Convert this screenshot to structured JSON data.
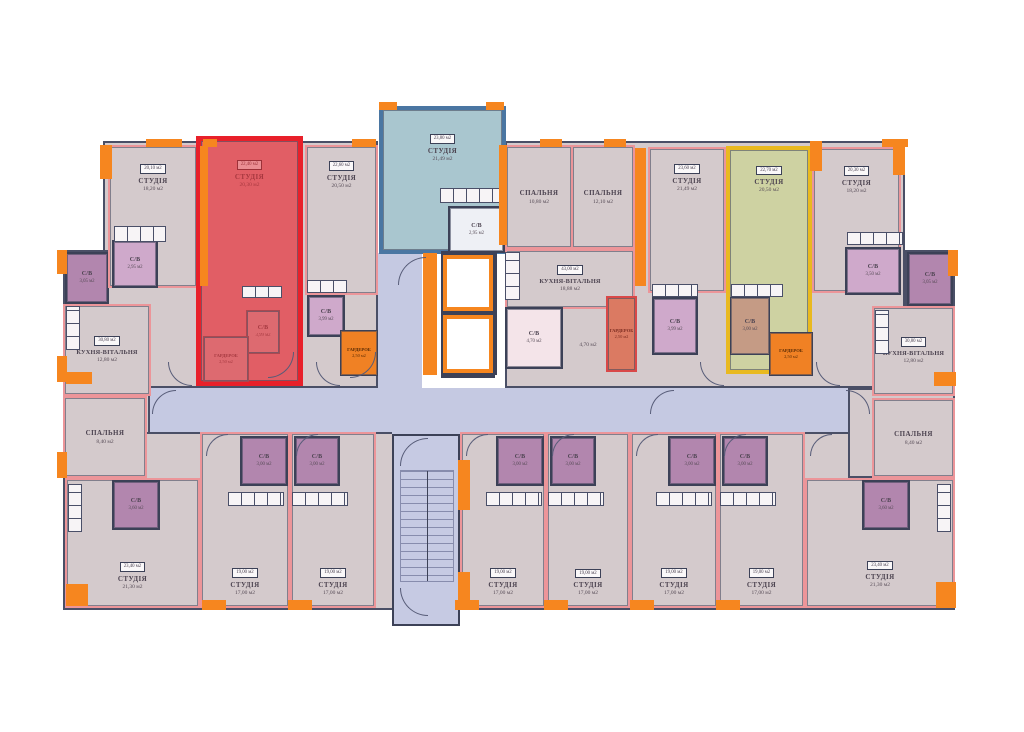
{
  "palette": {
    "wall": "#3c4157",
    "unit_wall": "#ec9599",
    "room_fill": "#d4cacc",
    "corridor_fill": "#c5c9e2",
    "orange": "#f6861f",
    "red_highlight_fill": "#e15e65",
    "red_highlight_border": "#e8202a",
    "blue_highlight_fill": "#a9c6cf",
    "blue_highlight_border": "#4a76a2",
    "yellow_highlight_fill": "#ced2a2",
    "yellow_highlight_border": "#e9b91f",
    "bath_fill": "#b286ae",
    "bath_fill_light": "#cfa9cb",
    "stairs_fill": "#c6cae3"
  },
  "base": [
    {
      "x": 103,
      "y": 141,
      "w": 275,
      "h": 247
    },
    {
      "x": 63,
      "y": 250,
      "w": 45,
      "h": 228
    },
    {
      "x": 103,
      "y": 388,
      "w": 47,
      "h": 90
    },
    {
      "x": 63,
      "y": 432,
      "w": 892,
      "h": 178
    },
    {
      "x": 505,
      "y": 141,
      "w": 400,
      "h": 247
    },
    {
      "x": 905,
      "y": 250,
      "w": 50,
      "h": 228
    },
    {
      "x": 848,
      "y": 388,
      "w": 107,
      "h": 90
    }
  ],
  "corridors": [
    {
      "x": 150,
      "y": 388,
      "w": 698,
      "h": 44
    },
    {
      "x": 378,
      "y": 253,
      "w": 44,
      "h": 137
    },
    {
      "x": 392,
      "y": 428,
      "w": 68,
      "h": 10
    }
  ],
  "rooms": [
    {
      "id": "bath-left-top",
      "t": "С/В",
      "a": "3,05 м2",
      "x": 65,
      "y": 252,
      "w": 44,
      "h": 52,
      "fill": "#b286ae",
      "border": "#3c4157",
      "bw": 2,
      "cls": "small"
    },
    {
      "id": "kitchen-living-left",
      "t": "КУХНЯ-ВІТАЛЬНЯ",
      "a": "12,80 м2",
      "b": "30,80 м2",
      "x": 63,
      "y": 304,
      "w": 88,
      "h": 92,
      "cls": "kitchenname"
    },
    {
      "id": "bedroom-left",
      "t": "СПАЛЬНЯ",
      "a": "8,40 м2",
      "x": 63,
      "y": 396,
      "w": 84,
      "h": 82
    },
    {
      "id": "studio-top-1",
      "t": "СТУДІЯ",
      "a": "18,20 м2",
      "b": "20,10 м2",
      "x": 108,
      "y": 145,
      "w": 90,
      "h": 143,
      "labelPos": "upper"
    },
    {
      "id": "bath-studio-1",
      "t": "С/В",
      "a": "2,95 м2",
      "x": 112,
      "y": 240,
      "w": 46,
      "h": 48,
      "fill": "#cfa9cb",
      "border": "#3c4157",
      "bw": 2,
      "cls": "small"
    },
    {
      "id": "apartment-red-studio",
      "t": "СТУДІЯ",
      "a": "20,30 м2",
      "b": "22,40 м2",
      "x": 196,
      "y": 136,
      "w": 107,
      "h": 250,
      "fill": "#e15e65",
      "border": "#e8202a",
      "bw": 5,
      "cls": "t-red",
      "labelPos": "upper"
    },
    {
      "id": "bath-red",
      "t": "С/В",
      "a": "3,99 м2",
      "x": 246,
      "y": 310,
      "w": 34,
      "h": 44,
      "fill": "#dd6a70",
      "border": "#aa4850",
      "bw": 1.5,
      "cls": "small t-red"
    },
    {
      "id": "wardrobe-red",
      "t": "ГАРДЕРОБ",
      "a": "2,50 м2",
      "x": 203,
      "y": 336,
      "w": 46,
      "h": 46,
      "fill": "#dd6a70",
      "border": "#aa4850",
      "bw": 1.5,
      "cls": "tiny t-red"
    },
    {
      "id": "studio-top-2",
      "t": "СТУДІЯ",
      "a": "20,50 м2",
      "b": "22,60 м2",
      "x": 305,
      "y": 145,
      "w": 73,
      "h": 150,
      "labelPos": "upper"
    },
    {
      "id": "bath-studio-2",
      "t": "С/В",
      "a": "3,99 м2",
      "x": 307,
      "y": 295,
      "w": 38,
      "h": 42,
      "fill": "#cfa9cb",
      "border": "#3c4157",
      "bw": 2,
      "cls": "small"
    },
    {
      "id": "wardrobe-studio-2",
      "t": "ГАРДЕРОБ",
      "a": "2,50 м2",
      "x": 340,
      "y": 330,
      "w": 38,
      "h": 46,
      "fill": "#f08124",
      "border": "#3c4157",
      "bw": 1.5,
      "cls": "tiny t-orange"
    },
    {
      "id": "apartment-blue-studio",
      "t": "СТУДІЯ",
      "a": "21,49 м2",
      "b": "23,80 м2",
      "x": 379,
      "y": 106,
      "w": 127,
      "h": 148,
      "fill": "#a9c6cf",
      "border": "#4a76a2",
      "bw": 4,
      "labelPos": "upper"
    },
    {
      "id": "bath-blue",
      "t": "С/В",
      "a": "2,95 м2",
      "x": 448,
      "y": 206,
      "w": 57,
      "h": 47,
      "fill": "#eef0f5",
      "border": "#3c4157",
      "bw": 2,
      "cls": "small"
    },
    {
      "id": "bedroom-center-1",
      "t": "СПАЛЬНЯ",
      "a": "10,80 м2",
      "x": 505,
      "y": 145,
      "w": 68,
      "h": 104,
      "dashedRight": true
    },
    {
      "id": "bedroom-center-2",
      "t": "СПАЛЬНЯ",
      "a": "12,10 м2",
      "x": 571,
      "y": 145,
      "w": 64,
      "h": 104
    },
    {
      "id": "kitchen-living-center",
      "t": "КУХНЯ-ВІТАЛЬНЯ",
      "a": "18,88 м2",
      "b": "43,00 м2",
      "x": 505,
      "y": 249,
      "w": 130,
      "h": 60,
      "cls": "kitchenname"
    },
    {
      "id": "bath-center",
      "t": "С/В",
      "a": "4,70 м2",
      "x": 505,
      "y": 307,
      "w": 58,
      "h": 62,
      "fill": "#f4e4e9",
      "border": "#3c4157",
      "bw": 2,
      "cls": "small"
    },
    {
      "id": "wardrobe-center",
      "t": "ГАРДЕРОБ",
      "a": "2,50 м2",
      "x": 606,
      "y": 296,
      "w": 31,
      "h": 76,
      "fill": "#db7a62",
      "border": "#d94848",
      "bw": 2,
      "cls": "tiny t-redward"
    },
    {
      "id": "studio-top-3",
      "t": "СТУДІЯ",
      "a": "21,49 м2",
      "b": "23,60 м2",
      "x": 648,
      "y": 147,
      "w": 78,
      "h": 146,
      "labelPos": "upper"
    },
    {
      "id": "bath-studio-3",
      "t": "С/В",
      "a": "3,99 м2",
      "x": 652,
      "y": 297,
      "w": 46,
      "h": 58,
      "fill": "#cfa9cb",
      "border": "#3c4157",
      "bw": 2,
      "cls": "small"
    },
    {
      "id": "apartment-yellow-studio",
      "t": "СТУДІЯ",
      "a": "20,50 м2",
      "b": "22,70 м2",
      "x": 726,
      "y": 146,
      "w": 86,
      "h": 228,
      "fill": "#ced2a2",
      "border": "#e9b91f",
      "bw": 4,
      "labelPos": "upper"
    },
    {
      "id": "bath-yellow",
      "t": "С/В",
      "a": "3,00 м2",
      "x": 730,
      "y": 297,
      "w": 40,
      "h": 58,
      "fill": "#c59b85",
      "border": "#3c4157",
      "bw": 1.5,
      "cls": "small"
    },
    {
      "id": "wardrobe-yellow",
      "t": "ГАРДЕРОБ",
      "a": "2,50 м2",
      "x": 769,
      "y": 332,
      "w": 44,
      "h": 44,
      "fill": "#f08124",
      "border": "#3c4157",
      "bw": 1.5,
      "cls": "tiny t-orange"
    },
    {
      "id": "studio-top-4",
      "t": "СТУДІЯ",
      "a": "18,20 м2",
      "b": "20,30 м2",
      "x": 812,
      "y": 147,
      "w": 89,
      "h": 146,
      "labelPos": "upper"
    },
    {
      "id": "bath-studio-4",
      "t": "С/В",
      "a": "3,50 м2",
      "x": 845,
      "y": 247,
      "w": 56,
      "h": 48,
      "fill": "#cfa9cb",
      "border": "#3c4157",
      "bw": 2,
      "cls": "small"
    },
    {
      "id": "bath-right-top",
      "t": "С/В",
      "a": "3,05 м2",
      "x": 907,
      "y": 252,
      "w": 46,
      "h": 54,
      "fill": "#b286ae",
      "border": "#3c4157",
      "bw": 2,
      "cls": "small"
    },
    {
      "id": "kitchen-living-right",
      "t": "КУХНЯ-ВІТАЛЬНЯ",
      "a": "12,80 м2",
      "b": "30,80 м2",
      "x": 872,
      "y": 306,
      "w": 83,
      "h": 90,
      "cls": "kitchenname"
    },
    {
      "id": "bedroom-right",
      "t": "СПАЛЬНЯ",
      "a": "8,40 м2",
      "x": 872,
      "y": 398,
      "w": 83,
      "h": 80
    },
    {
      "id": "studio-corner-bl",
      "t": "СТУДІЯ",
      "a": "21,30 м2",
      "b": "23,40 м2",
      "x": 65,
      "y": 478,
      "w": 135,
      "h": 130,
      "labelPos": "lower"
    },
    {
      "id": "bath-corner-bl",
      "t": "С/В",
      "a": "3,60 м2",
      "x": 112,
      "y": 480,
      "w": 48,
      "h": 50,
      "fill": "#b286ae",
      "border": "#3c4157",
      "bw": 2,
      "cls": "small"
    },
    {
      "id": "studio-bottom-1",
      "t": "СТУДІЯ",
      "a": "17,00 м2",
      "b": "19,00 м2",
      "x": 200,
      "y": 432,
      "w": 90,
      "h": 176,
      "labelPos": "lower"
    },
    {
      "id": "bath-bottom-1",
      "t": "С/В",
      "a": "3,00 м2",
      "x": 240,
      "y": 436,
      "w": 48,
      "h": 50,
      "fill": "#b286ae",
      "border": "#3c4157",
      "bw": 2,
      "cls": "small"
    },
    {
      "id": "studio-bottom-2",
      "t": "СТУДІЯ",
      "a": "17,00 м2",
      "b": "19,00 м2",
      "x": 290,
      "y": 432,
      "w": 86,
      "h": 176,
      "labelPos": "lower"
    },
    {
      "id": "bath-bottom-2",
      "t": "С/В",
      "a": "3,00 м2",
      "x": 294,
      "y": 436,
      "w": 46,
      "h": 50,
      "fill": "#b286ae",
      "border": "#3c4157",
      "bw": 2,
      "cls": "small"
    },
    {
      "id": "studio-bottom-3",
      "t": "СТУДІЯ",
      "a": "17,00 м2",
      "b": "19,00 м2",
      "x": 460,
      "y": 432,
      "w": 86,
      "h": 176,
      "labelPos": "lower"
    },
    {
      "id": "bath-bottom-3",
      "t": "С/В",
      "a": "3,00 м2",
      "x": 496,
      "y": 436,
      "w": 48,
      "h": 50,
      "fill": "#b286ae",
      "border": "#3c4157",
      "bw": 2,
      "cls": "small"
    },
    {
      "id": "studio-bottom-4",
      "t": "СТУДІЯ",
      "a": "17,00 м2",
      "b": "19,00 м2",
      "x": 546,
      "y": 432,
      "w": 84,
      "h": 176,
      "labelPos": "lower"
    },
    {
      "id": "bath-bottom-4",
      "t": "С/В",
      "a": "3,00 м2",
      "x": 550,
      "y": 436,
      "w": 46,
      "h": 50,
      "fill": "#b286ae",
      "border": "#3c4157",
      "bw": 2,
      "cls": "small"
    },
    {
      "id": "studio-bottom-5",
      "t": "СТУДІЯ",
      "a": "17,00 м2",
      "b": "19,00 м2",
      "x": 630,
      "y": 432,
      "w": 88,
      "h": 176,
      "labelPos": "lower"
    },
    {
      "id": "bath-bottom-5",
      "t": "С/В",
      "a": "3,00 м2",
      "x": 668,
      "y": 436,
      "w": 48,
      "h": 50,
      "fill": "#b286ae",
      "border": "#3c4157",
      "bw": 2,
      "cls": "small"
    },
    {
      "id": "studio-bottom-6",
      "t": "СТУДІЯ",
      "a": "17,00 м2",
      "b": "19,00 м2",
      "x": 718,
      "y": 432,
      "w": 87,
      "h": 176,
      "labelPos": "lower"
    },
    {
      "id": "bath-bottom-6",
      "t": "С/В",
      "a": "3,00 м2",
      "x": 722,
      "y": 436,
      "w": 46,
      "h": 50,
      "fill": "#b286ae",
      "border": "#3c4157",
      "bw": 2,
      "cls": "small"
    },
    {
      "id": "studio-corner-br",
      "t": "СТУДІЯ",
      "a": "21,30 м2",
      "b": "23,40 м2",
      "x": 805,
      "y": 478,
      "w": 150,
      "h": 130,
      "labelPos": "lower"
    },
    {
      "id": "bath-corner-br",
      "t": "С/В",
      "a": "3,60 м2",
      "x": 862,
      "y": 480,
      "w": 48,
      "h": 50,
      "fill": "#b286ae",
      "border": "#3c4157",
      "bw": 2,
      "cls": "small"
    }
  ],
  "elevators": [
    {
      "x": 443,
      "y": 255,
      "w": 50,
      "h": 56
    },
    {
      "x": 443,
      "y": 315,
      "w": 50,
      "h": 58
    }
  ],
  "stairs": {
    "box": {
      "x": 392,
      "y": 434,
      "w": 68,
      "h": 192
    },
    "flight": {
      "x": 400,
      "y": 470,
      "w": 54,
      "h": 112
    }
  },
  "kitchens": [
    {
      "x": 114,
      "y": 226,
      "w": 52,
      "h": 16,
      "dir": "h"
    },
    {
      "x": 307,
      "y": 280,
      "w": 40,
      "h": 13,
      "dir": "h"
    },
    {
      "x": 440,
      "y": 188,
      "w": 60,
      "h": 15,
      "dir": "h"
    },
    {
      "x": 652,
      "y": 284,
      "w": 46,
      "h": 13,
      "dir": "h"
    },
    {
      "x": 731,
      "y": 284,
      "w": 52,
      "h": 13,
      "dir": "h"
    },
    {
      "x": 847,
      "y": 232,
      "w": 56,
      "h": 13,
      "dir": "h"
    },
    {
      "x": 505,
      "y": 252,
      "w": 15,
      "h": 48,
      "dir": "v"
    },
    {
      "x": 66,
      "y": 306,
      "w": 14,
      "h": 44,
      "dir": "v"
    },
    {
      "x": 875,
      "y": 310,
      "w": 14,
      "h": 44,
      "dir": "v"
    },
    {
      "x": 228,
      "y": 492,
      "w": 56,
      "h": 14,
      "dir": "h"
    },
    {
      "x": 292,
      "y": 492,
      "w": 56,
      "h": 14,
      "dir": "h"
    },
    {
      "x": 486,
      "y": 492,
      "w": 56,
      "h": 14,
      "dir": "h"
    },
    {
      "x": 548,
      "y": 492,
      "w": 56,
      "h": 14,
      "dir": "h"
    },
    {
      "x": 656,
      "y": 492,
      "w": 56,
      "h": 14,
      "dir": "h"
    },
    {
      "x": 720,
      "y": 492,
      "w": 56,
      "h": 14,
      "dir": "h"
    },
    {
      "x": 68,
      "y": 484,
      "w": 14,
      "h": 48,
      "dir": "v"
    },
    {
      "x": 937,
      "y": 484,
      "w": 14,
      "h": 48,
      "dir": "v"
    },
    {
      "x": 242,
      "y": 286,
      "w": 40,
      "h": 12,
      "dir": "h"
    }
  ],
  "accents": [
    {
      "x": 100,
      "y": 145,
      "w": 12,
      "h": 34,
      "c": "orange"
    },
    {
      "x": 146,
      "y": 139,
      "w": 36,
      "h": 8,
      "c": "orange"
    },
    {
      "x": 203,
      "y": 139,
      "w": 14,
      "h": 8,
      "c": "orange"
    },
    {
      "x": 352,
      "y": 139,
      "w": 24,
      "h": 8,
      "c": "orange"
    },
    {
      "x": 379,
      "y": 102,
      "w": 18,
      "h": 8,
      "c": "orange"
    },
    {
      "x": 486,
      "y": 102,
      "w": 18,
      "h": 8,
      "c": "orange"
    },
    {
      "x": 499,
      "y": 145,
      "w": 8,
      "h": 100,
      "c": "orange"
    },
    {
      "x": 200,
      "y": 146,
      "w": 8,
      "h": 140,
      "c": "orange"
    },
    {
      "x": 635,
      "y": 148,
      "w": 11,
      "h": 138,
      "c": "orange"
    },
    {
      "x": 540,
      "y": 139,
      "w": 22,
      "h": 8,
      "c": "orange"
    },
    {
      "x": 604,
      "y": 139,
      "w": 22,
      "h": 8,
      "c": "orange"
    },
    {
      "x": 882,
      "y": 139,
      "w": 26,
      "h": 8,
      "c": "orange"
    },
    {
      "x": 893,
      "y": 145,
      "w": 12,
      "h": 30,
      "c": "orange"
    },
    {
      "x": 810,
      "y": 141,
      "w": 12,
      "h": 30,
      "c": "orange"
    },
    {
      "x": 57,
      "y": 250,
      "w": 10,
      "h": 24,
      "c": "orange"
    },
    {
      "x": 57,
      "y": 356,
      "w": 10,
      "h": 26,
      "c": "orange"
    },
    {
      "x": 66,
      "y": 372,
      "w": 26,
      "h": 12,
      "c": "orange"
    },
    {
      "x": 57,
      "y": 452,
      "w": 10,
      "h": 26,
      "c": "orange"
    },
    {
      "x": 66,
      "y": 584,
      "w": 22,
      "h": 22,
      "c": "orange"
    },
    {
      "x": 202,
      "y": 600,
      "w": 24,
      "h": 10,
      "c": "orange"
    },
    {
      "x": 288,
      "y": 600,
      "w": 24,
      "h": 10,
      "c": "orange"
    },
    {
      "x": 455,
      "y": 600,
      "w": 24,
      "h": 10,
      "c": "orange"
    },
    {
      "x": 544,
      "y": 600,
      "w": 24,
      "h": 10,
      "c": "orange"
    },
    {
      "x": 630,
      "y": 600,
      "w": 24,
      "h": 10,
      "c": "orange"
    },
    {
      "x": 716,
      "y": 600,
      "w": 24,
      "h": 10,
      "c": "orange"
    },
    {
      "x": 936,
      "y": 582,
      "w": 20,
      "h": 26,
      "c": "orange"
    },
    {
      "x": 934,
      "y": 372,
      "w": 22,
      "h": 14,
      "c": "orange"
    },
    {
      "x": 948,
      "y": 250,
      "w": 10,
      "h": 26,
      "c": "orange"
    },
    {
      "x": 423,
      "y": 253,
      "w": 14,
      "h": 122,
      "c": "orange"
    },
    {
      "x": 458,
      "y": 460,
      "w": 12,
      "h": 50,
      "c": "orange"
    },
    {
      "x": 458,
      "y": 572,
      "w": 12,
      "h": 36,
      "c": "orange"
    },
    {
      "x": 441,
      "y": 251,
      "w": 54,
      "h": 4,
      "c": "navy"
    },
    {
      "x": 441,
      "y": 374,
      "w": 54,
      "h": 4,
      "c": "navy"
    },
    {
      "x": 493,
      "y": 253,
      "w": 4,
      "h": 122,
      "c": "navy"
    }
  ],
  "doors": [
    {
      "x": 398,
      "y": 257,
      "s": 28,
      "corner": "tl"
    },
    {
      "x": 268,
      "y": 352,
      "s": 26,
      "corner": "br"
    },
    {
      "x": 350,
      "y": 352,
      "s": 26,
      "corner": "br"
    },
    {
      "x": 400,
      "y": 438,
      "s": 28,
      "corner": "tl"
    },
    {
      "x": 400,
      "y": 588,
      "s": 28,
      "corner": "bl"
    },
    {
      "x": 206,
      "y": 434,
      "s": 22,
      "corner": "tl"
    },
    {
      "x": 296,
      "y": 434,
      "s": 22,
      "corner": "tl"
    },
    {
      "x": 466,
      "y": 434,
      "s": 22,
      "corner": "tl"
    },
    {
      "x": 552,
      "y": 434,
      "s": 22,
      "corner": "tl"
    },
    {
      "x": 636,
      "y": 434,
      "s": 22,
      "corner": "tl"
    },
    {
      "x": 724,
      "y": 434,
      "s": 22,
      "corner": "tl"
    },
    {
      "x": 810,
      "y": 434,
      "s": 22,
      "corner": "tl"
    },
    {
      "x": 168,
      "y": 362,
      "s": 24,
      "corner": "bl"
    },
    {
      "x": 316,
      "y": 362,
      "s": 24,
      "corner": "bl"
    },
    {
      "x": 700,
      "y": 362,
      "s": 24,
      "corner": "bl"
    },
    {
      "x": 816,
      "y": 362,
      "s": 24,
      "corner": "bl"
    },
    {
      "x": 650,
      "y": 390,
      "s": 24,
      "corner": "tl"
    },
    {
      "x": 846,
      "y": 390,
      "s": 24,
      "corner": "tr"
    },
    {
      "x": 152,
      "y": 390,
      "s": 24,
      "corner": "tl"
    }
  ],
  "loose_labels": [
    {
      "text": "4,70 м2",
      "x": 566,
      "y": 342,
      "w": 44
    }
  ]
}
